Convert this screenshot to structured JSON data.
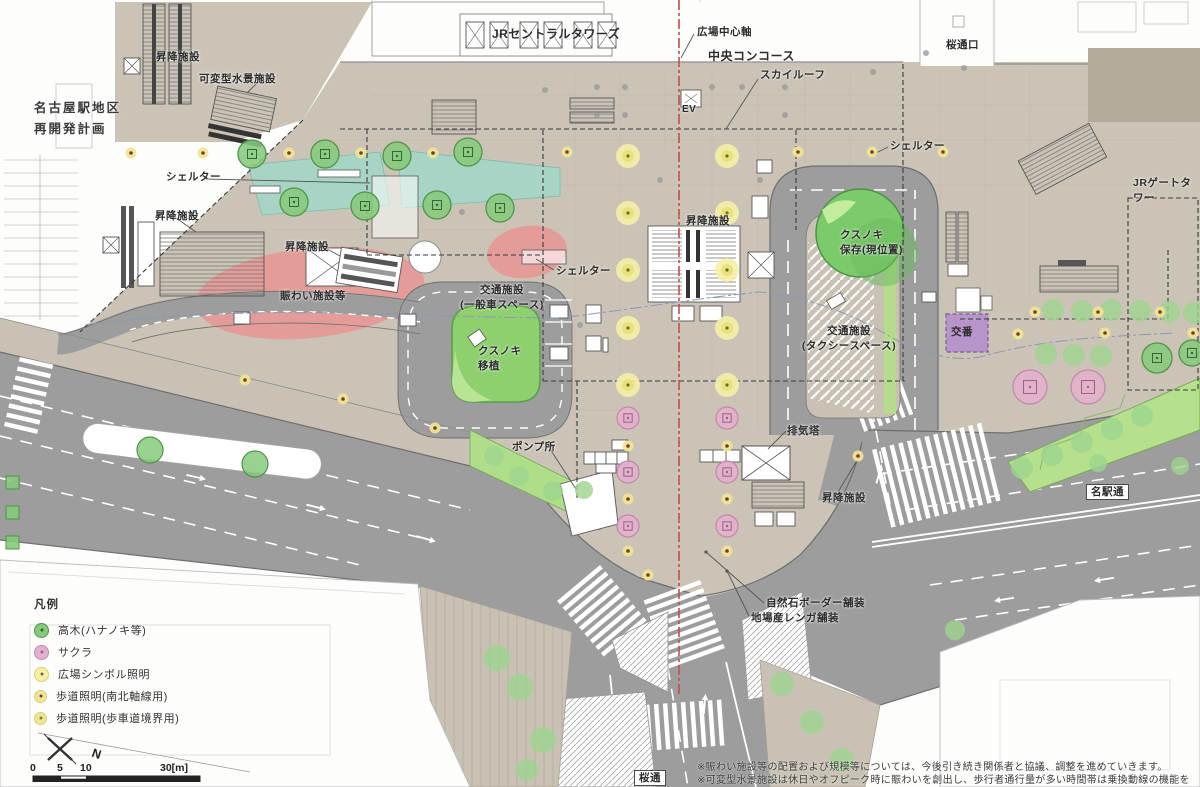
{
  "site_title": "名古屋駅地区\n再開発計画",
  "labels": {
    "jr_central_towers": "JRセントラルタワーズ",
    "plaza_center_axis": "広場中心軸",
    "central_concourse": "中央コンコース",
    "sakura_dori_exit": "桜通口",
    "sky_roof": "スカイルーフ",
    "ev": "EV",
    "jr_gate_tower": "JRゲートタワー",
    "shelter": "シェルター",
    "elevator": "昇降施設",
    "water_feature": "可変型水景施設",
    "nigiwai": "賑わい施設等",
    "traffic_general": "交通施設\n(一般車スペース)",
    "kusunoki_transplant": "クスノキ\n移植",
    "kusunoki_preserve": "クスノキ\n保存(現位置)",
    "traffic_taxi": "交通施設\n(タクシースペース)",
    "koban": "交番",
    "pump_station": "ポンプ所",
    "exhaust_tower": "排気塔",
    "paving_stone": "自然石ボーダー舗装",
    "paving_brick": "地場産レンガ舗装",
    "meieki_dori": "名駅通",
    "sakura_dori": "桜通"
  },
  "legend": {
    "title": "凡例",
    "items": [
      {
        "label": "高木(ハナノキ等)",
        "type": "tree"
      },
      {
        "label": "サクラ",
        "type": "sakura"
      },
      {
        "label": "広場シンボル照明",
        "type": "symbol"
      },
      {
        "label": "歩道照明(南北軸線用)",
        "type": "path_ns"
      },
      {
        "label": "歩道照明(歩車道境界用)",
        "type": "path_edge"
      }
    ]
  },
  "scale_bar": {
    "ticks": [
      "0",
      "5",
      "10",
      "30[m]"
    ]
  },
  "north_label": "N",
  "notes": [
    "※賑わい施設等の配置および規模等については、今後引き続き関係者と協議、調整を進めていきます。",
    "※可変型水景施設は休日やオフピーク時に賑わいを創出し、歩行者通行量が多い時間帯は乗換動線の機能を併せ持つものです。"
  ],
  "colors": {
    "plaza": "#cbc4b6",
    "road": "#9d9d9d",
    "building": "#fdfdfc",
    "outline": "#999999",
    "tree": "#86ca7c",
    "tree_stroke": "#4f9447",
    "tree_soft": "#9ed48e",
    "sakura": "#e4b0cf",
    "sakura_stroke": "#c585ac",
    "symbol_light": "#e9e27a",
    "symbol_halo": "#f5f0a8",
    "path_light": "#efe594",
    "path_light_center": "#7a3c26",
    "water": "#9fd8cb",
    "nigiwai": "#ec8f8f",
    "kusunoki": "#8ed06e",
    "koban": "#b794c9",
    "terrace": "#b6e18c",
    "axis": "#c84b4b",
    "guide": "#8a97b5"
  },
  "map_features": {
    "trees_sq": [
      [
        252,
        154
      ],
      [
        325,
        154
      ],
      [
        397,
        156
      ],
      [
        468,
        152
      ],
      [
        294,
        202
      ],
      [
        365,
        206
      ],
      [
        437,
        205
      ],
      [
        500,
        208
      ],
      [
        1157,
        358,
        15
      ],
      [
        1192,
        353,
        13
      ]
    ],
    "trees_plain": [
      [
        150,
        450
      ],
      [
        255,
        464
      ]
    ],
    "trees_soft": [
      [
        1053,
        310,
        11
      ],
      [
        1082,
        311,
        11
      ],
      [
        1111,
        310,
        11
      ],
      [
        1140,
        311,
        11
      ],
      [
        1169,
        312,
        11
      ],
      [
        1194,
        313,
        11
      ],
      [
        1046,
        354,
        11
      ],
      [
        1074,
        355,
        11
      ],
      [
        1101,
        356,
        11
      ],
      [
        1022,
        468,
        11
      ],
      [
        1052,
        455,
        11
      ],
      [
        1082,
        442,
        11
      ],
      [
        1112,
        429,
        11
      ],
      [
        1142,
        416,
        11
      ],
      [
        1098,
        463,
        9
      ],
      [
        1180,
        466,
        9
      ],
      [
        497,
        658,
        13
      ],
      [
        520,
        687,
        13
      ],
      [
        543,
        740,
        13
      ],
      [
        527,
        770,
        11
      ],
      [
        494,
        456,
        10
      ],
      [
        519,
        476,
        10
      ],
      [
        553,
        491,
        10
      ],
      [
        584,
        490,
        9
      ],
      [
        782,
        684,
        12
      ],
      [
        812,
        722,
        12
      ],
      [
        842,
        760,
        12
      ],
      [
        955,
        630,
        10
      ]
    ],
    "sakura": [
      [
        628,
        418,
        11
      ],
      [
        628,
        472,
        11
      ],
      [
        628,
        526,
        11
      ],
      [
        727,
        418,
        11
      ],
      [
        727,
        472,
        11
      ],
      [
        727,
        526,
        11
      ],
      [
        1030,
        387,
        17
      ],
      [
        1088,
        387,
        17
      ]
    ],
    "symbol_lights": [
      [
        628,
        156
      ],
      [
        727,
        156
      ],
      [
        628,
        213
      ],
      [
        727,
        213
      ],
      [
        628,
        270
      ],
      [
        727,
        270
      ],
      [
        628,
        328
      ],
      [
        727,
        328
      ],
      [
        628,
        385
      ],
      [
        727,
        385
      ]
    ],
    "path_lights": [
      [
        131,
        153
      ],
      [
        203,
        153
      ],
      [
        289,
        153
      ],
      [
        361,
        153
      ],
      [
        433,
        153
      ],
      [
        567,
        152
      ],
      [
        798,
        152
      ],
      [
        872,
        152
      ],
      [
        943,
        152
      ],
      [
        245,
        380
      ],
      [
        343,
        399
      ],
      [
        435,
        428
      ],
      [
        628,
        446
      ],
      [
        628,
        499
      ],
      [
        628,
        551
      ],
      [
        727,
        446
      ],
      [
        727,
        499
      ],
      [
        727,
        551
      ],
      [
        1018,
        334
      ],
      [
        1105,
        333
      ],
      [
        1193,
        333
      ],
      [
        1035,
        312
      ],
      [
        1098,
        312
      ],
      [
        1160,
        312
      ],
      [
        858,
        456
      ],
      [
        648,
        575
      ]
    ],
    "gray_dots": [
      [
        926,
        53
      ],
      [
        964,
        68
      ],
      [
        873,
        72
      ],
      [
        597,
        87
      ],
      [
        625,
        87
      ],
      [
        712,
        87
      ],
      [
        742,
        87
      ],
      [
        785,
        87
      ],
      [
        597,
        115
      ],
      [
        785,
        115
      ],
      [
        625,
        115
      ],
      [
        545,
        90
      ],
      [
        462,
        212
      ],
      [
        580,
        325
      ],
      [
        660,
        180
      ],
      [
        760,
        180
      ]
    ],
    "green_squares": [
      [
        6,
        476
      ],
      [
        6,
        506
      ],
      [
        6,
        536
      ]
    ]
  }
}
